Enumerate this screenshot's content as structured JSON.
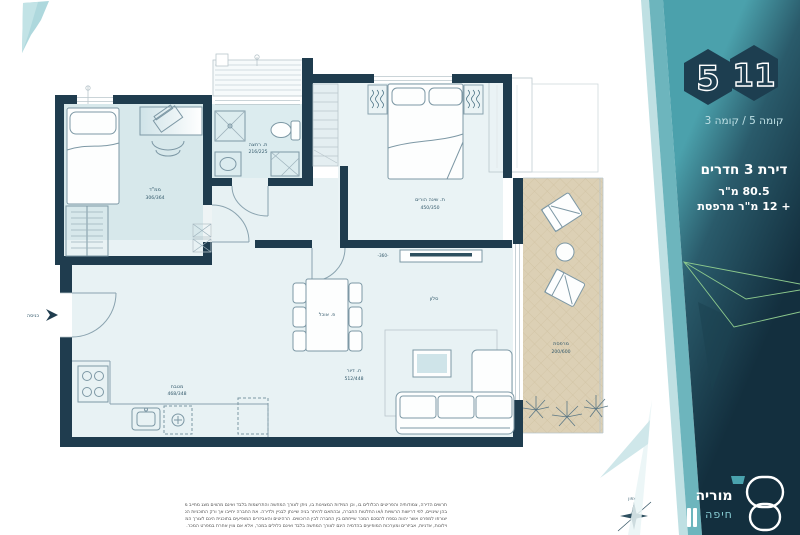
{
  "side_panel": {
    "hex_floor": "5",
    "hex_unit": "11",
    "floor_line": "קומה 5 / קומה 3",
    "apartment": {
      "title": "דירת 3 חדרים",
      "area": "80.5 מ\"ר",
      "balcony": "+ 12 מ\"ר מרפסת"
    },
    "logo": {
      "name": "מוריה",
      "city": "חיפה"
    }
  },
  "plan": {
    "entrance_label": "כניסה",
    "north_label": "צפון",
    "hall_dim": "-360-",
    "rooms": {
      "mamad": {
        "name": "ממ\"ד",
        "dims": "306/364"
      },
      "bathroom": {
        "name": "ת. רחצה",
        "dims": "216/225"
      },
      "parents": {
        "name": "ת. שינה הורים",
        "dims": "450/350"
      },
      "salon": {
        "name": "סלון",
        "dims": ""
      },
      "dining": {
        "name": "פ. אוכל",
        "dims": ""
      },
      "kitchen": {
        "name": "מטבח",
        "dims": "468/348"
      },
      "living": {
        "name": "ח. דיור",
        "dims": "512/448"
      },
      "balcony": {
        "name": "מרפסת",
        "dims": "200/600"
      }
    }
  },
  "disclaimer": {
    "line1": "תרשים הדירה, צמודותיה והפריטים הכלולים בו, וכן המידות המצוינות בו, ניתן לצורך המחשה והתרשמות בלבד ואינם מהווים מצג מחייב מצד החברה. התוכניות עשויות להשתנות",
    "line2": "בהן שינויים, לפי דרישות הרשויות ו/או החלטות החברה, ובהתאם להיתר בניה שיינתן לבניין ולדירה. את החברה יחייבו אך ורק התוכניות הסופיות לאחר קבלת ההיתר, אשר",
    "line3": "יצורפו למפרט אשר יהווה נספח להסכם המכר שייחתם בין החברה לבין הרוכשים. הרהיטים והאביזרים המופיעים בתוכנית הינם לצורך המחשה בלבד. ריהוט, חפצי נוי, גופי תאורה,",
    "line4": "וילונות, אדניות, אביזרים ומערכות המופיעים בהדמיה הינם לצורך המחשה בלבד ואינם כלולים במכר, אלא אם צוין אחרת במפרט המכר."
  },
  "colors": {
    "wall": "#1f3c4e",
    "teal": "#4aa1ac",
    "balcony_floor": "#dcd0b5",
    "panel_dark": "#132f3e"
  }
}
